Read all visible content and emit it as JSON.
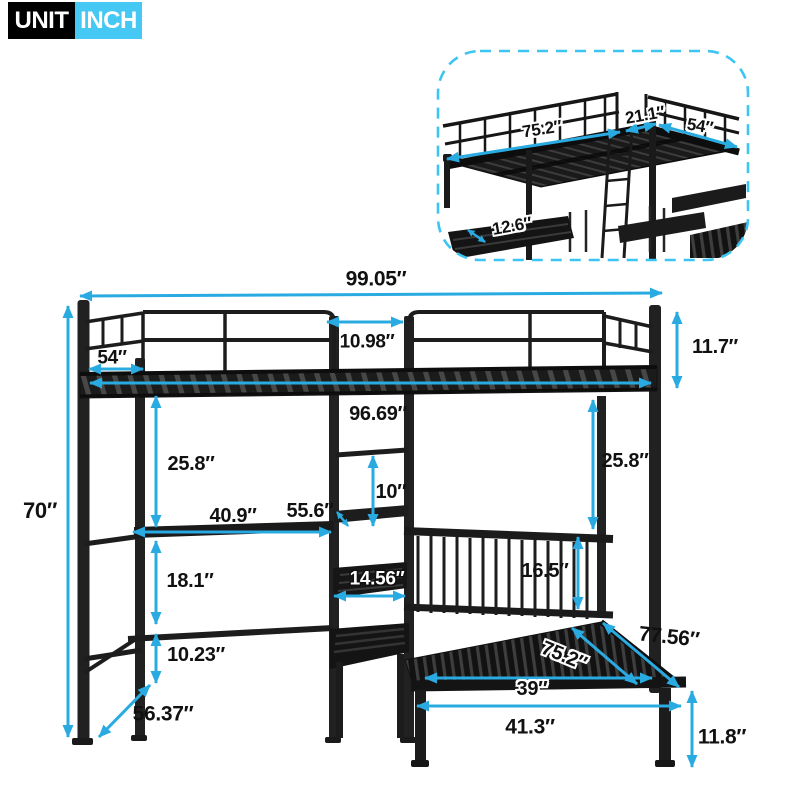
{
  "badge": {
    "unit_label": "UNIT",
    "unit_value": "INCH"
  },
  "colors": {
    "accent": "#29abe2",
    "badge_cyan": "#45c8f3",
    "dash_border": "#3cc5f2",
    "frame_black": "#1c1c1c"
  },
  "inset": {
    "dims": {
      "bed_length": "75.2″",
      "ladder_opening": "21.1″",
      "bed_width": "54″",
      "shelf_depth": "12.6″"
    }
  },
  "main": {
    "dims": {
      "total_length": "99.05″",
      "total_height": "70″",
      "side_depth": "54″",
      "ladder_opening": "10.98″",
      "guardrail_height": "11.7″",
      "inner_length": "96.69″",
      "clearance_left": "25.8″",
      "clearance_right": "25.8″",
      "desk_length": "40.9″",
      "desk_height": "55.6″",
      "shelf_gap": "10″",
      "desk_to_shelf": "18.1″",
      "shelf_width": "14.56″",
      "headboard_height": "16.5″",
      "lower_gap": "10.23″",
      "desk_depth": "56.37″",
      "bed_length_inner": "75.2″",
      "bed_length_outer": "77.56″",
      "bed_width_inner": "39″",
      "bed_width_outer": "41.3″",
      "bed_height": "11.8″"
    }
  }
}
